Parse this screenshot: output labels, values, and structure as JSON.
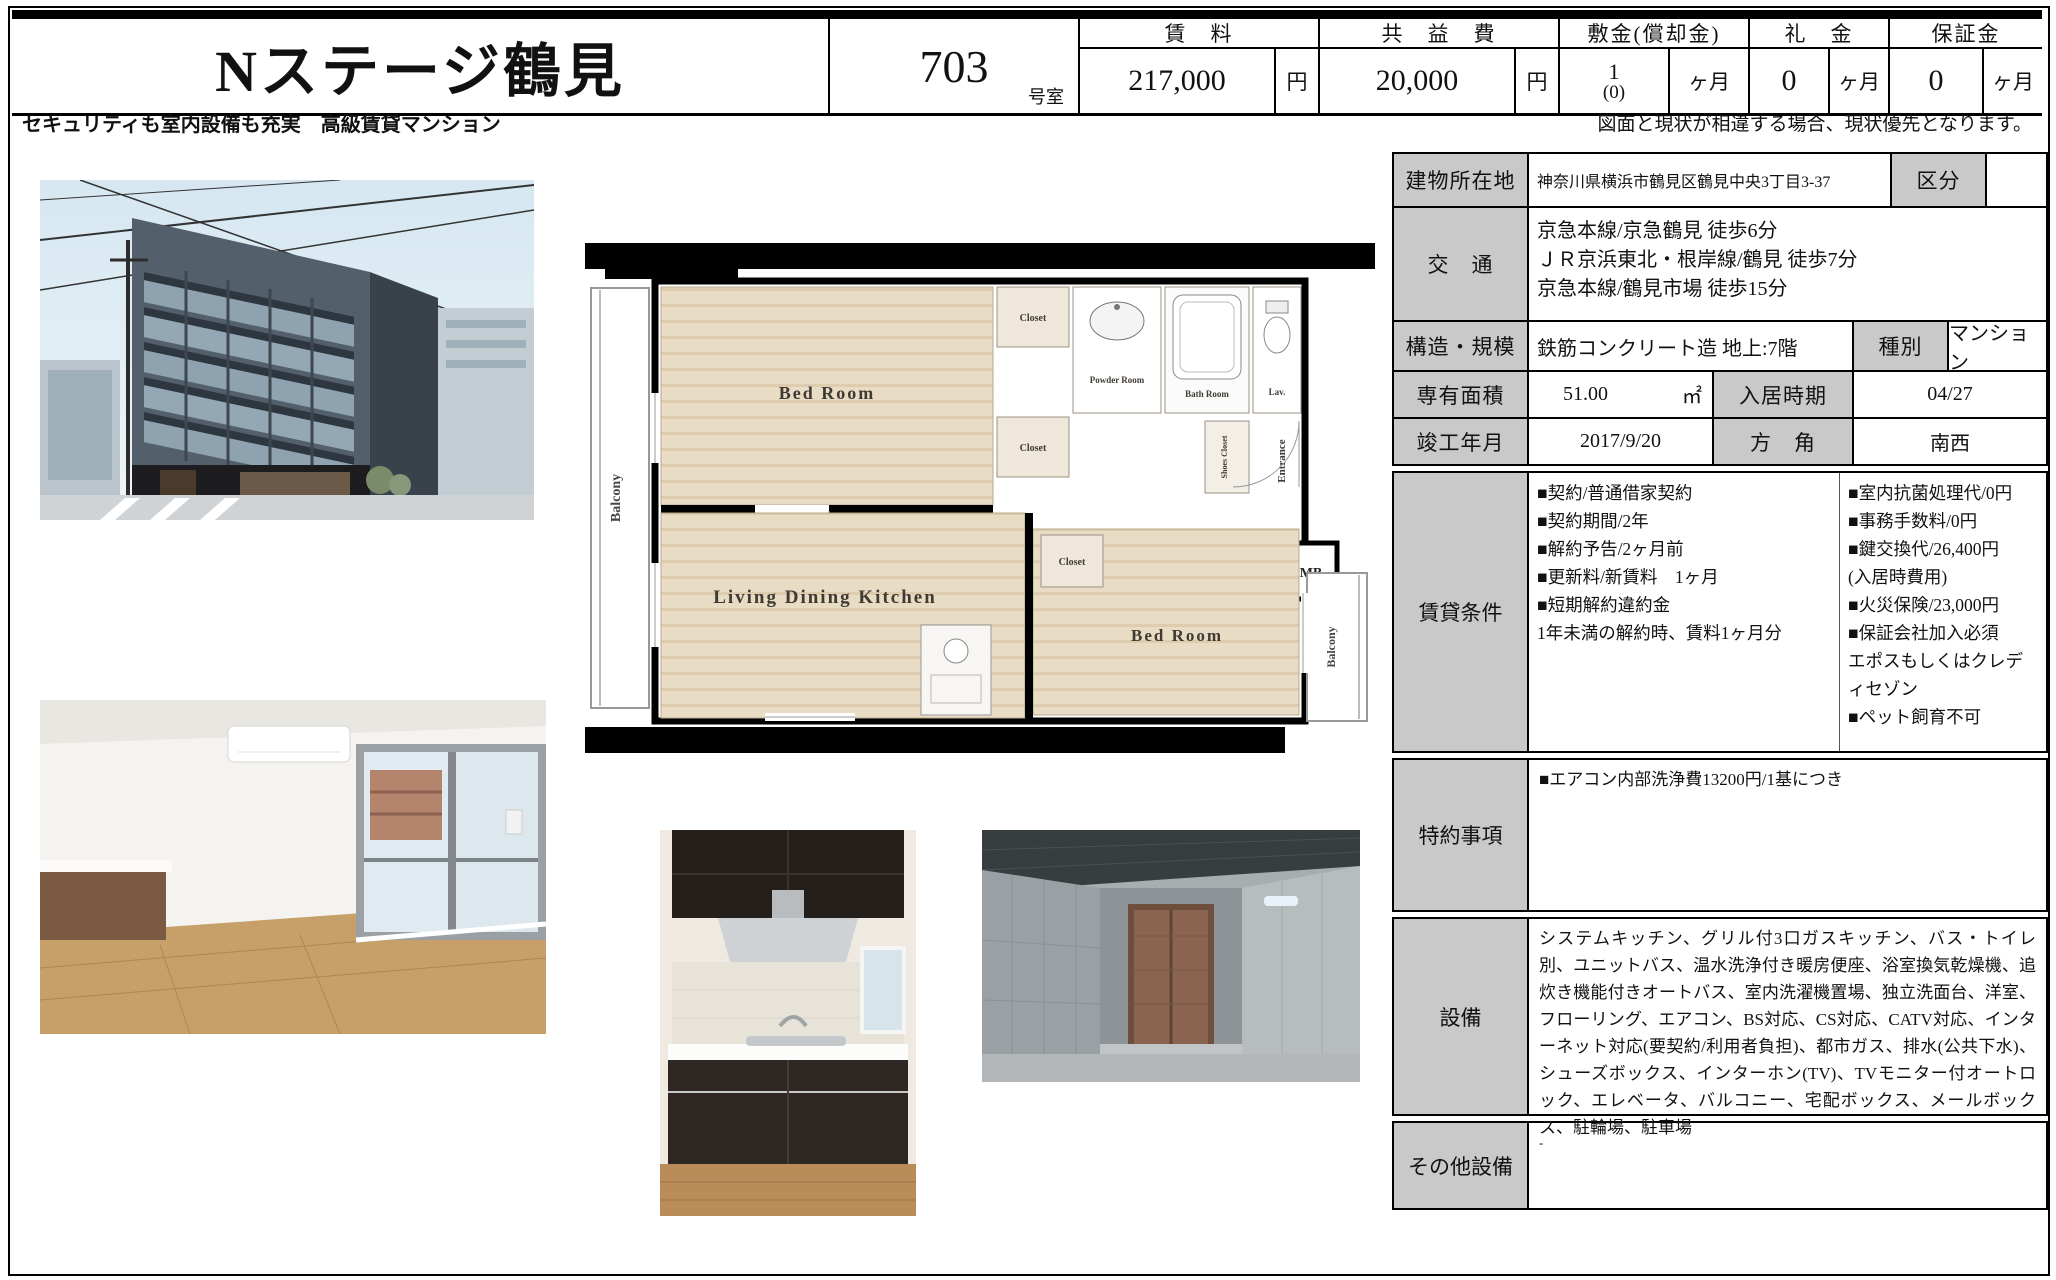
{
  "header": {
    "property_name": "Nステージ鶴見",
    "room_number": "703",
    "room_suffix": "号室",
    "fees": [
      {
        "label": "賃　料",
        "value": "217,000",
        "sub": "",
        "unit": "円"
      },
      {
        "label": "共　益　費",
        "value": "20,000",
        "sub": "",
        "unit": "円"
      },
      {
        "label": "敷金(償却金)",
        "value": "1",
        "sub": "(0)",
        "unit": "ヶ月"
      },
      {
        "label": "礼　金",
        "value": "0",
        "sub": "",
        "unit": "ヶ月"
      },
      {
        "label": "保証金",
        "value": "0",
        "sub": "",
        "unit": "ヶ月"
      }
    ]
  },
  "subheader": {
    "catch_copy": "セキュリティも室内設備も充実　高級賃貸マンション",
    "disclaimer": "図面と現状が相違する場合、現状優先となります。"
  },
  "details": {
    "address_label": "建物所在地",
    "address": "神奈川県横浜市鶴見区鶴見中央3丁目3-37",
    "category_label": "区分",
    "category": "",
    "access_label": "交　通",
    "access": "京急本線/京急鶴見 徒歩6分\nＪＲ京浜東北・根岸線/鶴見 徒歩7分\n京急本線/鶴見市場 徒歩15分",
    "structure_label": "構造・規模",
    "structure": "鉄筋コンクリート造 地上:7階",
    "type_label": "種別",
    "building_type": "マンション",
    "area_label": "専有面積",
    "area_value": "51.00",
    "area_unit": "㎡",
    "movein_label": "入居時期",
    "movein": "04/27",
    "completion_label": "竣工年月",
    "completion": "2017/9/20",
    "direction_label": "方　角",
    "direction": "南西"
  },
  "lease": {
    "label": "賃貸条件",
    "left": "■契約/普通借家契約\n■契約期間/2年\n■解約予告/2ヶ月前\n■更新料/新賃料　1ヶ月\n■短期解約違約金\n1年未満の解約時、賃料1ヶ月分",
    "right": "■室内抗菌処理代/0円\n■事務手数料/0円\n■鍵交換代/26,400円\n(入居時費用)\n■火災保険/23,000円\n■保証会社加入必須\nエポスもしくはクレディセゾン\n■ペット飼育不可"
  },
  "special": {
    "label": "特約事項",
    "text": "■エアコン内部洗浄費13200円/1基につき"
  },
  "equipment": {
    "label": "設備",
    "text": "システムキッチン、グリル付3口ガスキッチン、バス・トイレ別、ユニットバス、温水洗浄付き暖房便座、浴室換気乾燥機、追炊き機能付きオートバス、室内洗濯機置場、独立洗面台、洋室、フローリング、エアコン、BS対応、CS対応、CATV対応、インターネット対応(要契約/利用者負担)、都市ガス、排水(公共下水)、シューズボックス、インターホン(TV)、TVモニター付オートロック、エレベータ、バルコニー、宅配ボックス、メールボックス、駐輪場、駐車場"
  },
  "other": {
    "label": "その他設備",
    "text": "-"
  },
  "floorplan": {
    "balcony_left": "Balcony",
    "balcony_right": "Balcony",
    "bedroom1": "Bed Room",
    "bedroom2": "Bed Room",
    "ldk": "Living Dining Kitchen",
    "closet": "Closet",
    "powder_room": "Powder Room",
    "bath_room": "Bath Room",
    "lavatory": "Lav.",
    "shoes_closet": "Shoes Closet",
    "entrance": "Entrance",
    "meter_box": "MB"
  }
}
